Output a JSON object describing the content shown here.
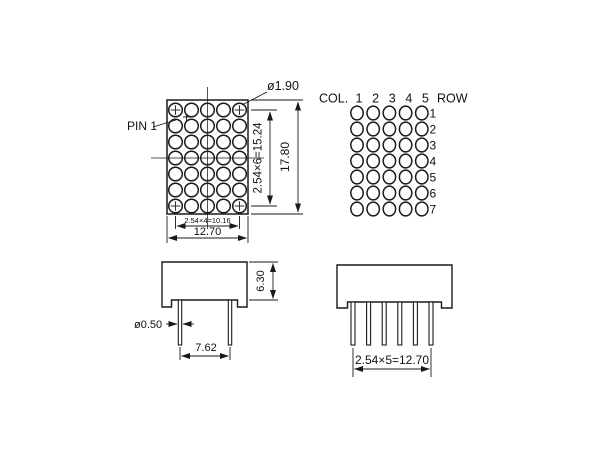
{
  "front_view": {
    "pin1_label": "PIN 1",
    "led_diameter": "ø1.90",
    "dim_row_pitch": "2.54×6=15.24",
    "dim_height": "17.80",
    "dim_col_pitch": "2.54×4=10.16",
    "dim_width": "12.70",
    "matrix": {
      "cols": 5,
      "rows": 7
    }
  },
  "pinout_view": {
    "col_label": "COL.",
    "col_numbers": [
      "1",
      "2",
      "3",
      "4",
      "5"
    ],
    "row_label": "ROW",
    "row_numbers": [
      "1",
      "2",
      "3",
      "4",
      "5",
      "6",
      "7"
    ],
    "matrix": {
      "cols": 5,
      "rows": 7
    }
  },
  "side_view_front": {
    "dim_body_height": "6.30",
    "pin_diameter": "ø0.50",
    "dim_pin_spacing": "7.62",
    "pins": 2
  },
  "side_view_side": {
    "dim_pin_row_length": "2.54×5=12.70",
    "pins": 6
  },
  "colors": {
    "background": "#ffffff",
    "line": "#1a1a1a"
  }
}
